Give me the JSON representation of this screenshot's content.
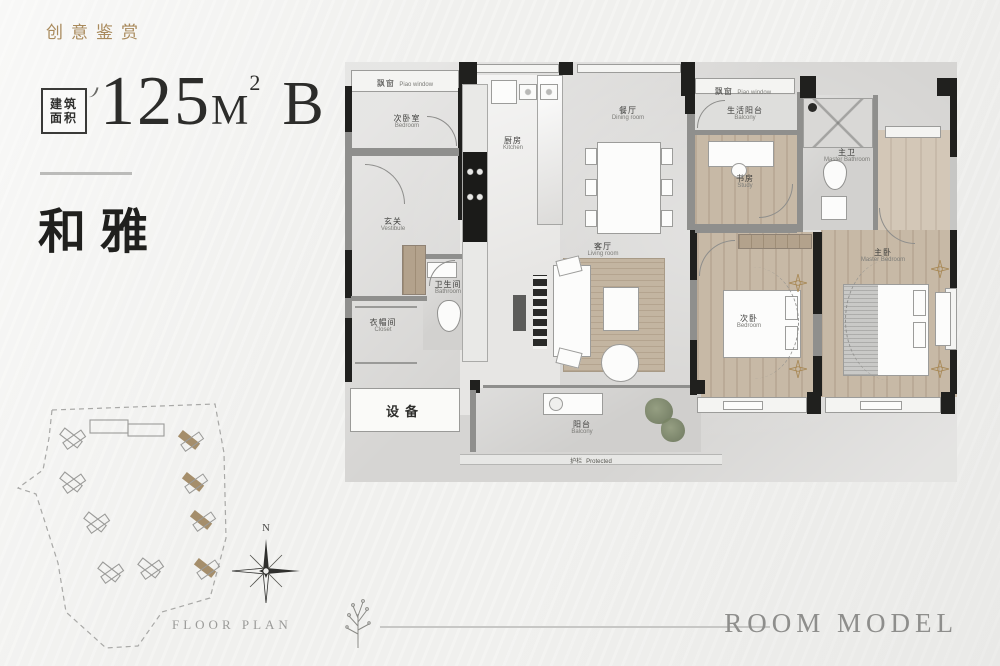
{
  "header": {
    "eyebrow": "创意鉴赏",
    "badge_line1": "建筑",
    "badge_line2": "面积",
    "area_value": "125",
    "area_unit": "M",
    "area_sup": "2",
    "plan_type": "B",
    "title": "和雅"
  },
  "plan": {
    "labels": {
      "bay_top_left": {
        "zh": "飘窗",
        "en": "Piao window"
      },
      "bedroom_tl": {
        "zh": "次卧室",
        "en": "Bedroom"
      },
      "kitchen": {
        "zh": "厨房",
        "en": "Kitchen"
      },
      "dining": {
        "zh": "餐厅",
        "en": "Dining room"
      },
      "living": {
        "zh": "客厅",
        "en": "Living room"
      },
      "vestibule": {
        "zh": "玄关",
        "en": "Vestibule"
      },
      "closet": {
        "zh": "衣帽间",
        "en": "Closet"
      },
      "bath": {
        "zh": "卫生间",
        "en": "Bathroom"
      },
      "equipment": {
        "zh": "设备"
      },
      "balcony": {
        "zh": "阳台",
        "en": "Balcony"
      },
      "rail": {
        "zh": "护栏",
        "en": "Protected"
      },
      "bay_top_right": {
        "zh": "飘窗",
        "en": "Piao window"
      },
      "service_balcony": {
        "zh": "生活阳台",
        "en": "Balcony"
      },
      "study": {
        "zh": "书房",
        "en": "Study"
      },
      "master_bath": {
        "zh": "主卫",
        "en": "Master Bathroom"
      },
      "bedroom": {
        "zh": "次卧",
        "en": "Bedroom"
      },
      "master_bedroom": {
        "zh": "主卧",
        "en": "Master Bedroom"
      }
    }
  },
  "footer": {
    "site_caption": "FLOOR PLAN",
    "compass_n": "N",
    "room_model": "ROOM MODEL"
  },
  "colors": {
    "accent_gold": "#a98a5c",
    "ink": "#2c2c2a",
    "caption_gray": "#8e8e8c",
    "site_tan": "#a58e6b",
    "bronze": "#a98a58",
    "wall_dark": "#20201e"
  }
}
